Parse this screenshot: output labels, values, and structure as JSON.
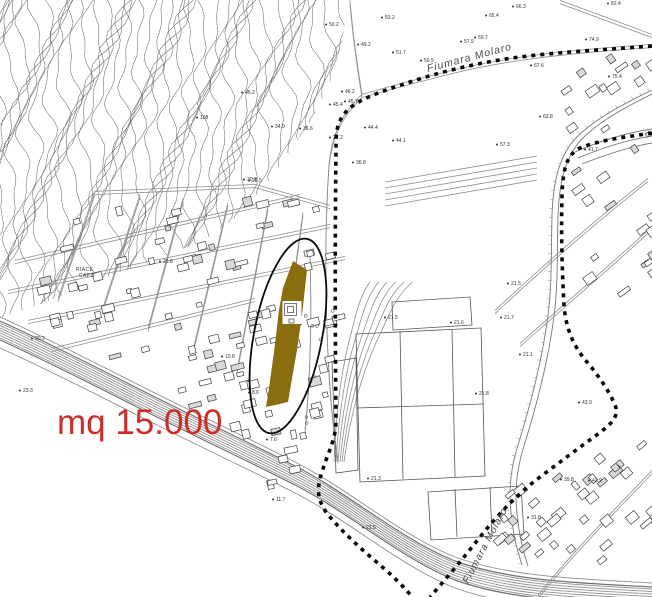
{
  "annotation": {
    "text": "mq 15.000"
  },
  "labels": {
    "river_top": "Fiumara Molaro",
    "river_lower": "Fiumara Molaro",
    "place_line1": "RIACE",
    "place_line2": "CAPO"
  },
  "colors": {
    "parcel_fill": "#8a6d0e",
    "annotation_red": "#cf2b28",
    "boundary_ink": "#0a0a0a",
    "contour_gray": "#6b6b6b",
    "road_gray": "#8d8d8d",
    "building_gray": "#3f3f3f",
    "label_gray": "#2f2f2f"
  },
  "overlay": {
    "parcel_polygon": "293,261 307,270 302,315 297,350 290,390 288,402 266,407 269,388 274,352 279,310 283,288",
    "parcel_notch": {
      "x": 282.5,
      "y": 301,
      "w": 19,
      "h": 23
    },
    "ellipse": {
      "cx": 288,
      "cy": 336,
      "rx": 34,
      "ry": 99,
      "rotation": 11
    }
  },
  "spot_elevations": [
    {
      "x": 385,
      "y": 19,
      "v": "53.2"
    },
    {
      "x": 489,
      "y": 17,
      "v": "65.4"
    },
    {
      "x": 516,
      "y": 8,
      "v": "66.3"
    },
    {
      "x": 611,
      "y": 5,
      "v": "82.4"
    },
    {
      "x": 478,
      "y": 39,
      "v": "59.7"
    },
    {
      "x": 464,
      "y": 43,
      "v": "57.9"
    },
    {
      "x": 589,
      "y": 41,
      "v": "74.9"
    },
    {
      "x": 396,
      "y": 54,
      "v": "51.7"
    },
    {
      "x": 424,
      "y": 62,
      "v": "50.5"
    },
    {
      "x": 361,
      "y": 46,
      "v": "49.2"
    },
    {
      "x": 345,
      "y": 93,
      "v": "46.2"
    },
    {
      "x": 348,
      "y": 103,
      "v": "45.7"
    },
    {
      "x": 333,
      "y": 106,
      "v": "45.4"
    },
    {
      "x": 245,
      "y": 94,
      "v": "45.2"
    },
    {
      "x": 275,
      "y": 128,
      "v": "34.9"
    },
    {
      "x": 303,
      "y": 130,
      "v": "36.6"
    },
    {
      "x": 333,
      "y": 139,
      "v": "37.2"
    },
    {
      "x": 368,
      "y": 129,
      "v": "44.4"
    },
    {
      "x": 396,
      "y": 142,
      "v": "44.1"
    },
    {
      "x": 356,
      "y": 164,
      "v": "36.8"
    },
    {
      "x": 252,
      "y": 182,
      "v": "25.5"
    },
    {
      "x": 200,
      "y": 119,
      "v": "108"
    },
    {
      "x": 247,
      "y": 181,
      "v": "30.2"
    },
    {
      "x": 534,
      "y": 67,
      "v": "67.6"
    },
    {
      "x": 543,
      "y": 118,
      "v": "63.8"
    },
    {
      "x": 612,
      "y": 78,
      "v": "75.4"
    },
    {
      "x": 588,
      "y": 151,
      "v": "41.7"
    },
    {
      "x": 500,
      "y": 146,
      "v": "57.3"
    },
    {
      "x": 329,
      "y": 26,
      "v": "50.2"
    },
    {
      "x": 225,
      "y": 358,
      "v": "10.8"
    },
    {
      "x": 252,
      "y": 394,
      "v": "8.6"
    },
    {
      "x": 270,
      "y": 441,
      "v": "7.6"
    },
    {
      "x": 276,
      "y": 501,
      "v": "11.7"
    },
    {
      "x": 388,
      "y": 319,
      "v": "21.5"
    },
    {
      "x": 454,
      "y": 324,
      "v": "21.6"
    },
    {
      "x": 504,
      "y": 319,
      "v": "21.7"
    },
    {
      "x": 523,
      "y": 356,
      "v": "21.1"
    },
    {
      "x": 479,
      "y": 395,
      "v": "21.8"
    },
    {
      "x": 371,
      "y": 480,
      "v": "21.3"
    },
    {
      "x": 366,
      "y": 529,
      "v": "21.5"
    },
    {
      "x": 531,
      "y": 519,
      "v": "31.8"
    },
    {
      "x": 564,
      "y": 481,
      "v": "39.8"
    },
    {
      "x": 592,
      "y": 482,
      "v": "42.9"
    },
    {
      "x": 582,
      "y": 404,
      "v": "43.9"
    },
    {
      "x": 511,
      "y": 285,
      "v": "21.5"
    },
    {
      "x": 35,
      "y": 340,
      "v": "20.2"
    },
    {
      "x": 23,
      "y": 392,
      "v": "23.3"
    },
    {
      "x": 163,
      "y": 263,
      "v": "25.8"
    }
  ]
}
